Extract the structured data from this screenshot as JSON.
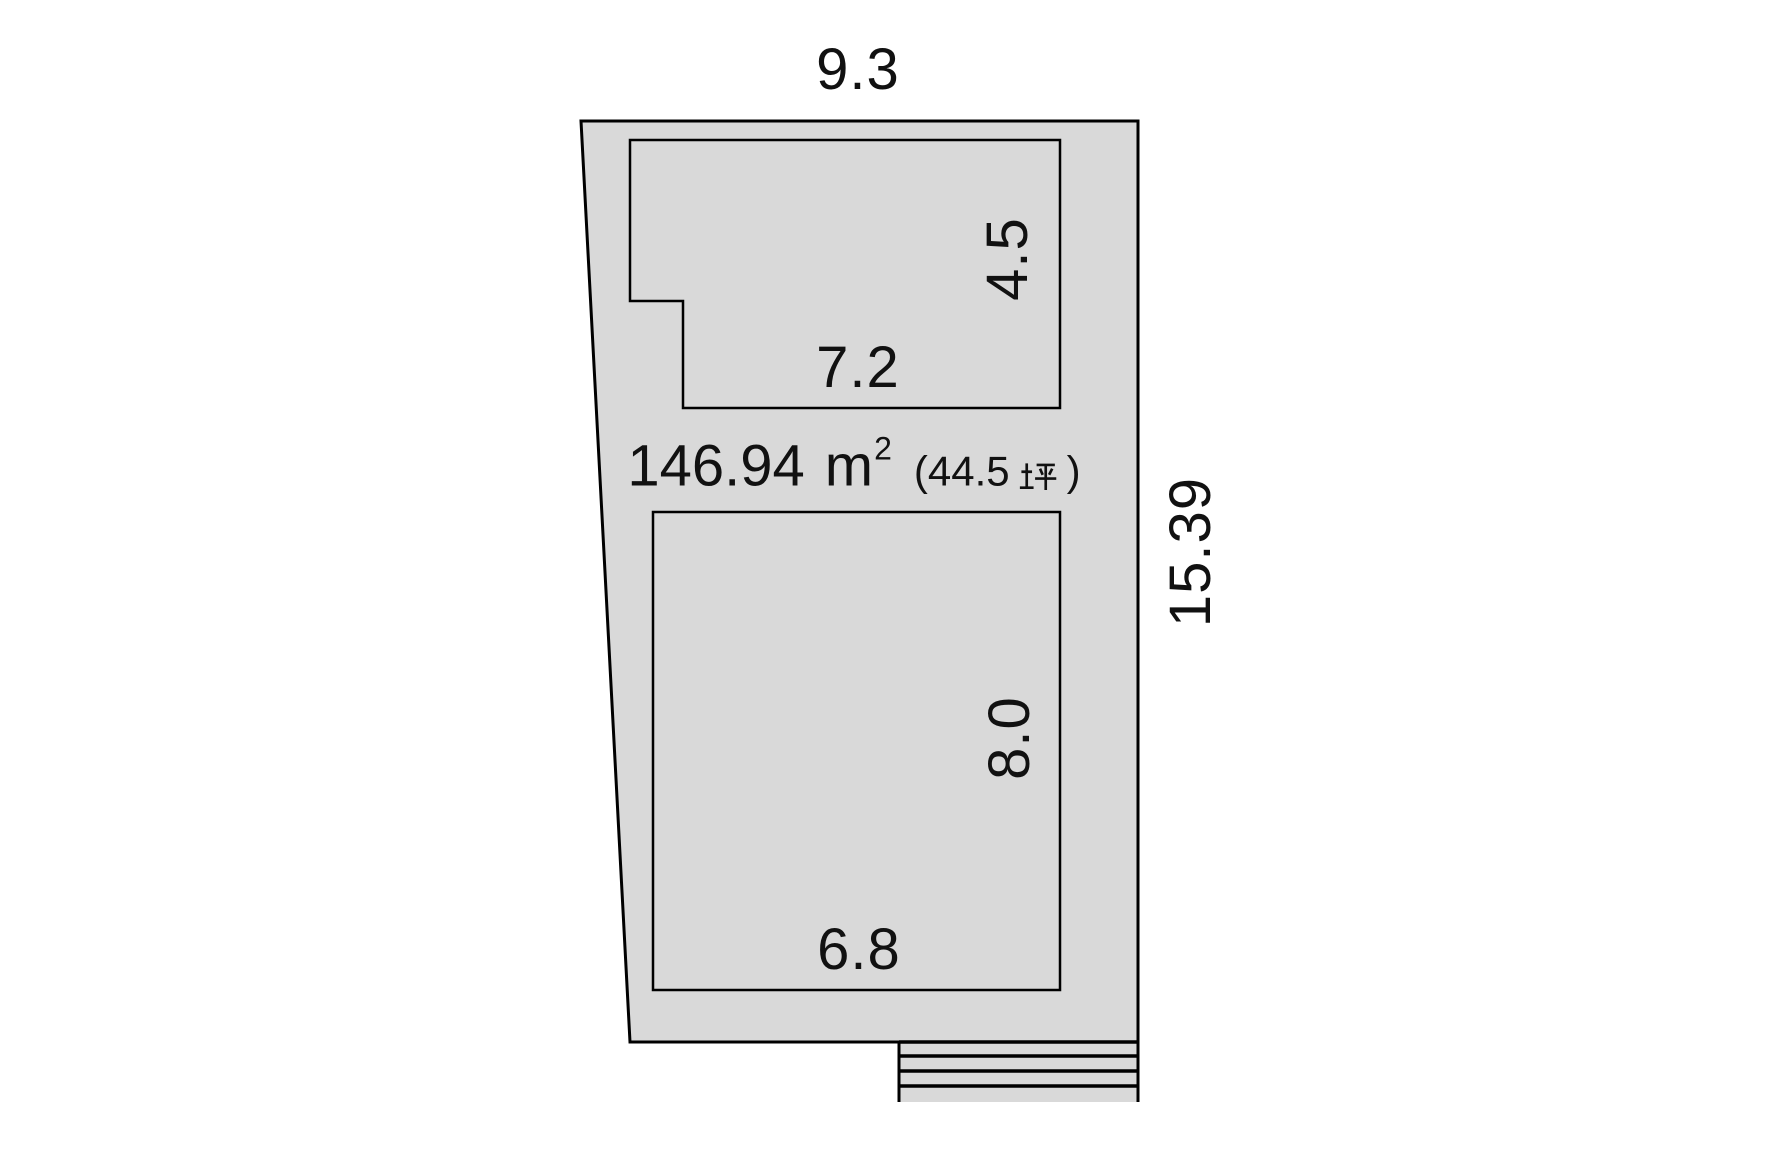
{
  "diagram": {
    "title": "land-plot-dimension-diagram",
    "lot": {
      "top_width": "9.3",
      "right_height": "15.39"
    },
    "area": {
      "value": "146.94",
      "unit_base": "m",
      "unit_sup": "2",
      "tsubo_prefix": "(44.5",
      "tsubo_char": "坪",
      "tsubo_suffix": ")"
    },
    "building_top": {
      "depth": "4.5",
      "width": "7.2"
    },
    "building_bottom": {
      "depth": "8.0",
      "width": "6.8"
    },
    "colors": {
      "lot_fill": "#d9d9d9",
      "line": "#000000",
      "background": "#ffffff",
      "text": "#111111"
    }
  }
}
